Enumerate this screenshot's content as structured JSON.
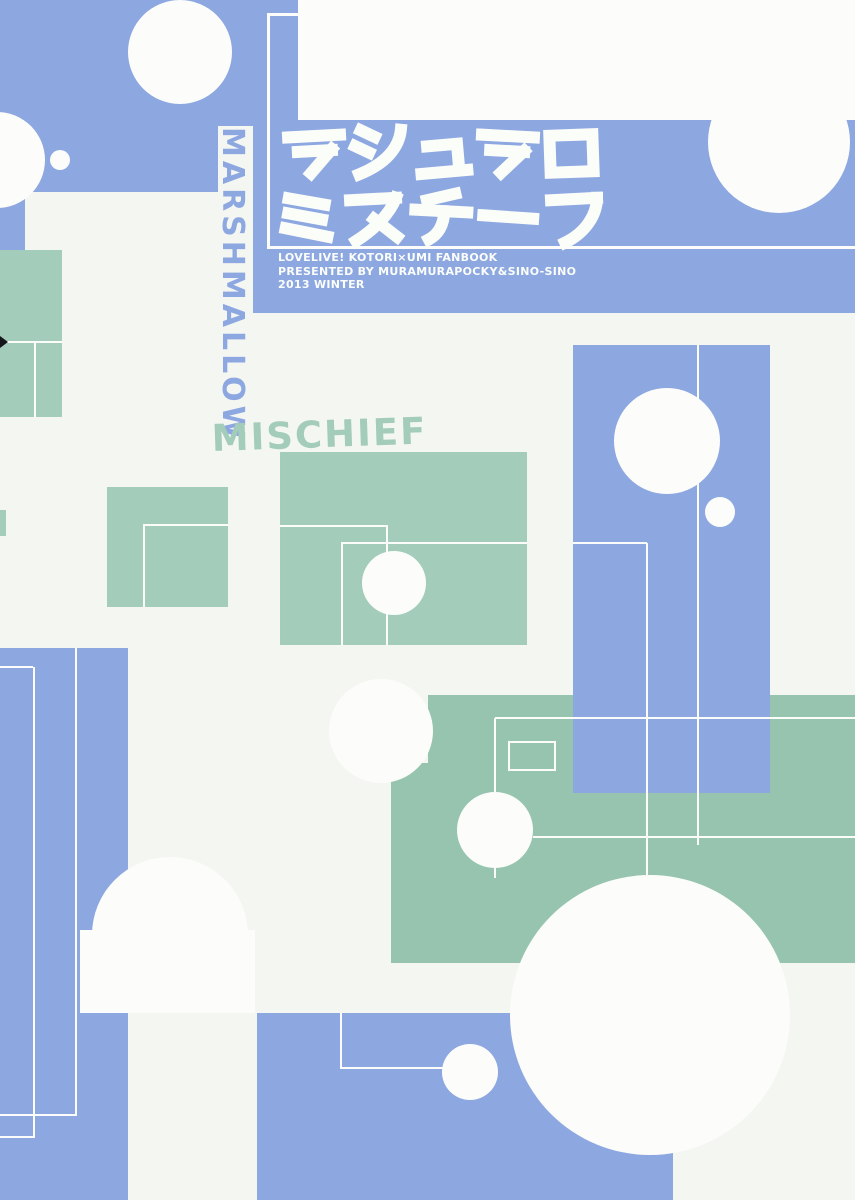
{
  "cover": {
    "title": {
      "line1": "マシュマロ",
      "line2": "ミスチーフ"
    },
    "subtitle_lines": [
      "LOVELIVE! KOTORI×UMI FANBOOK",
      "PRESENTED BY MURAMURAPOCKY&SINO-SINO",
      "2013 WINTER"
    ],
    "vertical_text": "MARSHMALLOW",
    "diagonal_text": "MISCHIEF"
  },
  "palette": {
    "background": "#f4f6f2",
    "blue": "#8da7e1",
    "green": "#a3ccba",
    "green2": "#96c4ae",
    "white": "#fcfdfb",
    "titleWhite": "#fbfdf9"
  }
}
